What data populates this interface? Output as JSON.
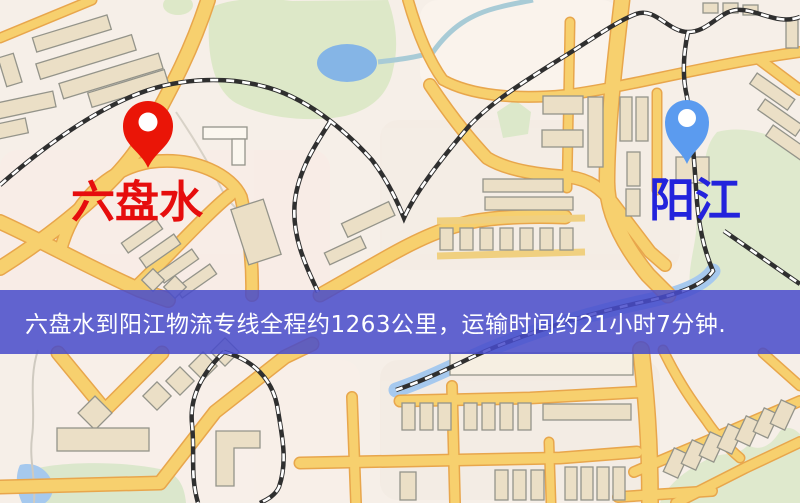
{
  "map": {
    "origin_marker": {
      "label": "六盘水"
    },
    "destination_marker": {
      "label": "阳江"
    },
    "banner": {
      "text": "六盘水到阳江物流专线全程约1263公里，运输时间约21小时7分钟."
    }
  },
  "colors": {
    "background": "#f6efe8",
    "road_fill": "#f7d06e",
    "road_casing": "#e8a64c",
    "railway": "#2f2f2f",
    "park_green": "#dde8c8",
    "water_blue": "#a6c9ee",
    "banner_background": "#484ccb",
    "banner_text": "#ffffff",
    "origin_pin": "#ea1507",
    "origin_label": "#e60d0d",
    "destination_pin": "#5b9bef",
    "destination_label": "#2323dc"
  }
}
